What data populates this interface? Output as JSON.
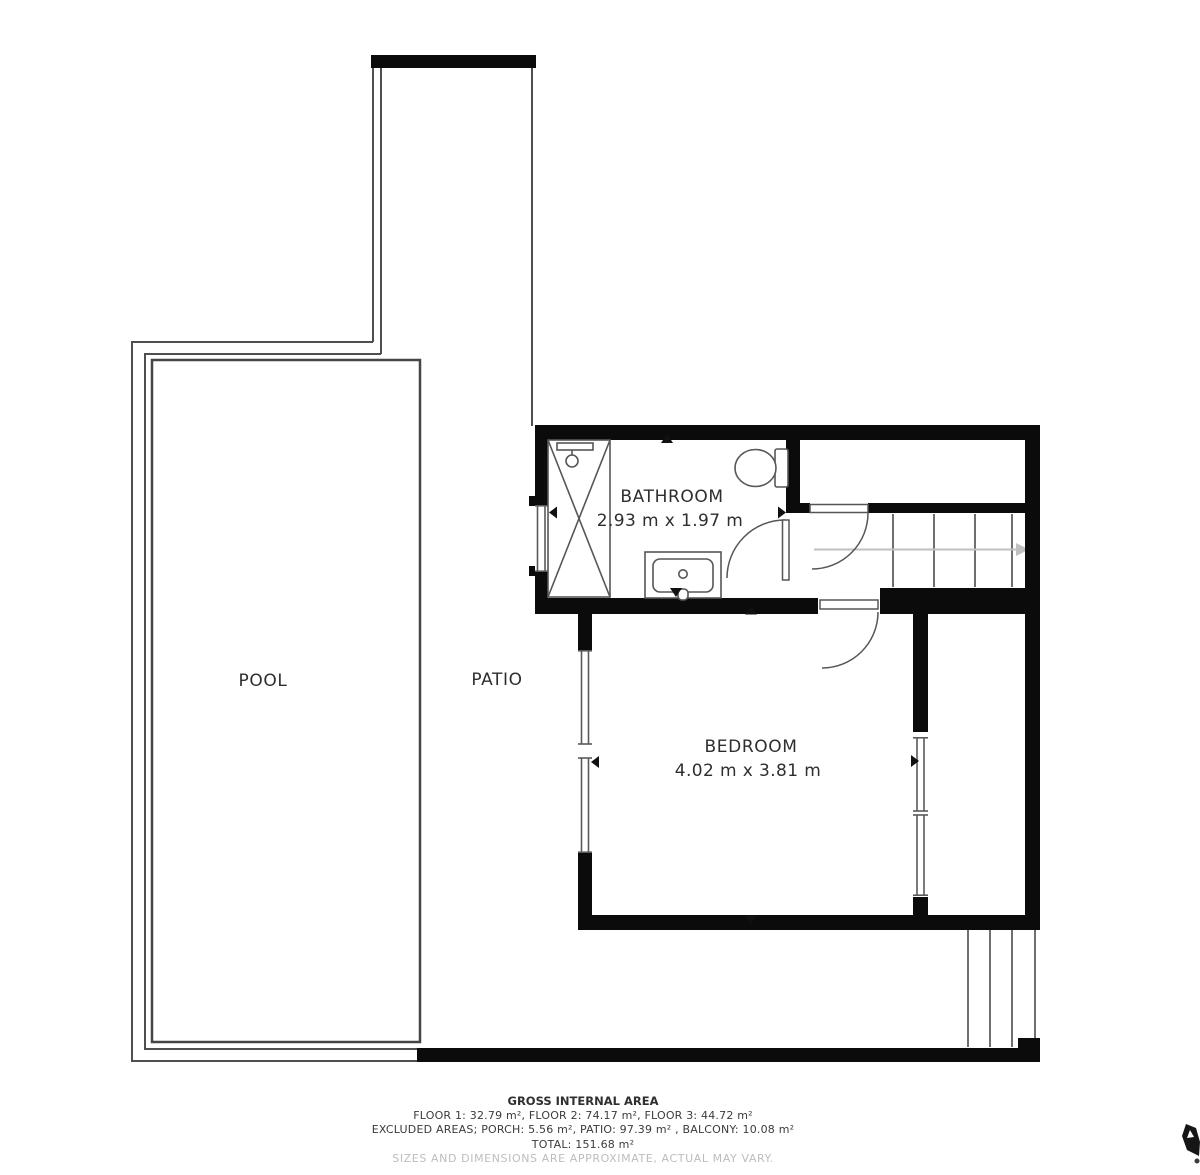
{
  "plan": {
    "pool_label": "POOL",
    "patio_label": "PATIO",
    "bathroom": {
      "name": "BATHROOM",
      "size": "2.93 m x 1.97 m"
    },
    "bedroom": {
      "name": "BEDROOM",
      "size": "4.02 m x 3.81 m"
    }
  },
  "footer": {
    "title": "GROSS INTERNAL AREA",
    "floors": "FLOOR 1: 32.79 m², FLOOR 2: 74.17 m², FLOOR 3: 44.72 m²",
    "excluded": "EXCLUDED AREAS; PORCH: 5.56 m², PATIO: 97.39 m² , BALCONY: 10.08 m²",
    "total": "TOTAL: 151.68 m²",
    "disclaimer": "SIZES AND DIMENSIONS ARE APPROXIMATE, ACTUAL MAY VARY."
  },
  "colors": {
    "wall": "#0b0b0b",
    "thin_line": "#4f4f4f",
    "fixture_line": "#565656",
    "stair_arrow": "#c0c0c0",
    "text": "#2e2e2e",
    "muted_text": "#bdbdbd"
  }
}
